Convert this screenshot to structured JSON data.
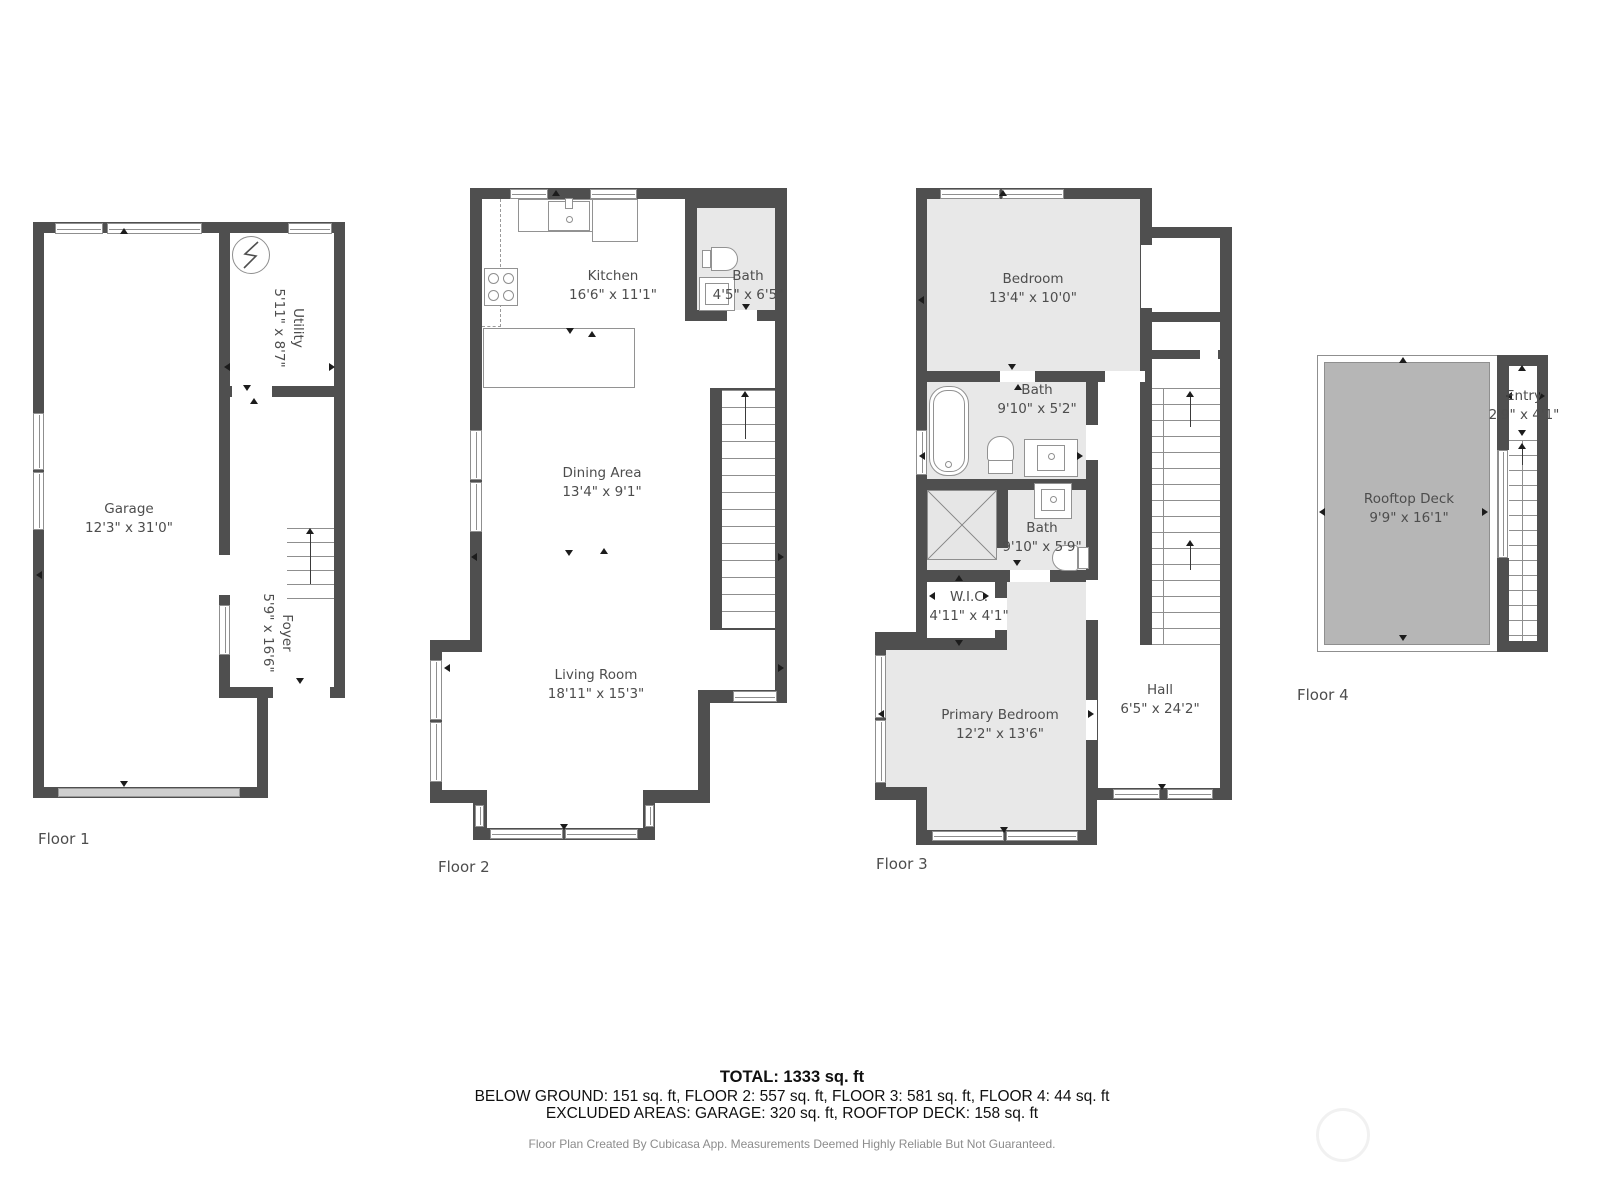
{
  "floors": [
    {
      "label": "Floor 1",
      "rooms": {
        "garage": {
          "name": "Garage",
          "dims": "12'3\" x 31'0\""
        },
        "utility": {
          "name": "Utility",
          "dims": "5'11\" x 8'7\""
        },
        "foyer": {
          "name": "Foyer",
          "dims": "5'9\" x 16'6\""
        }
      }
    },
    {
      "label": "Floor 2",
      "rooms": {
        "kitchen": {
          "name": "Kitchen",
          "dims": "16'6\" x 11'1\""
        },
        "bath": {
          "name": "Bath",
          "dims": "4'5\" x 6'5\""
        },
        "dining": {
          "name": "Dining Area",
          "dims": "13'4\" x 9'1\""
        },
        "living": {
          "name": "Living Room",
          "dims": "18'11\" x 15'3\""
        }
      }
    },
    {
      "label": "Floor 3",
      "rooms": {
        "bedroom": {
          "name": "Bedroom",
          "dims": "13'4\" x 10'0\""
        },
        "bath1": {
          "name": "Bath",
          "dims": "9'10\" x 5'2\""
        },
        "bath2": {
          "name": "Bath",
          "dims": "9'10\" x 5'9\""
        },
        "wic": {
          "name": "W.I.C.",
          "dims": "4'11\" x 4'1\""
        },
        "primary": {
          "name": "Primary Bedroom",
          "dims": "12'2\" x 13'6\""
        },
        "hall": {
          "name": "Hall",
          "dims": "6'5\" x 24'2\""
        }
      }
    },
    {
      "label": "Floor 4",
      "rooms": {
        "deck": {
          "name": "Rooftop Deck",
          "dims": "9'9\" x 16'1\""
        },
        "entry": {
          "name": "Entry",
          "dims": "2'9\" x 4'1\""
        }
      }
    }
  ],
  "summary": {
    "total": "TOTAL: 1333 sq. ft",
    "by_floor": "BELOW GROUND: 151 sq. ft, FLOOR 2: 557 sq. ft, FLOOR 3: 581 sq. ft, FLOOR 4: 44 sq. ft",
    "excluded": "EXCLUDED AREAS: GARAGE: 320 sq. ft, ROOFTOP DECK: 158 sq. ft"
  },
  "credit": "Floor Plan Created By Cubicasa App. Measurements Deemed Highly Reliable But Not Guaranteed.",
  "colors": {
    "wall": "#4f4f4f",
    "room_shaded": "#e8e8e8",
    "deck_fill": "#b6b6b6",
    "window_frame": "#8f8f8f",
    "garage_door": "#cfcfcf"
  }
}
